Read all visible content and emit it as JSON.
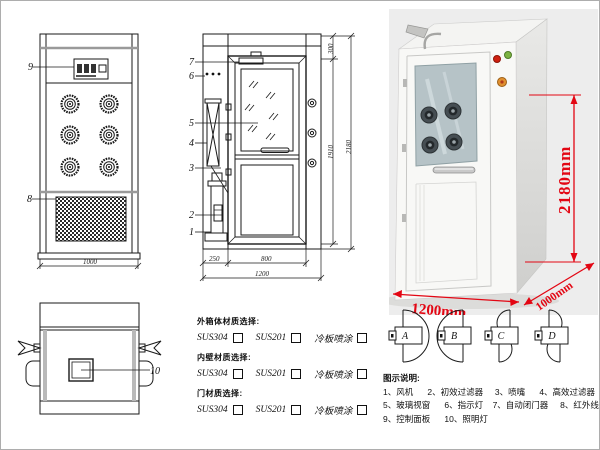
{
  "drawing": {
    "front_view": {
      "label_control_panel": "9",
      "label_grille": "8",
      "dim_width": "1000"
    },
    "side_view": {
      "labels": [
        "1",
        "2",
        "3",
        "4",
        "5",
        "6",
        "7"
      ],
      "dim_left": "250",
      "dim_door": "800",
      "dim_total": "1200",
      "dim_top": "300",
      "dim_mid": "1910",
      "dim_height": "2180"
    },
    "top_view": {
      "label_window": "10"
    }
  },
  "photo": {
    "dim_height": "2180mm",
    "dim_width": "1200mm",
    "dim_depth": "1000mm"
  },
  "materials": {
    "groups": [
      {
        "heading": "外箱体材质选择:",
        "options": [
          {
            "label": "SUS304"
          },
          {
            "label": "SUS201"
          },
          {
            "label": "冷板喷涂"
          }
        ]
      },
      {
        "heading": "内壁材质选择:",
        "options": [
          {
            "label": "SUS304"
          },
          {
            "label": "SUS201"
          },
          {
            "label": "冷板喷涂"
          }
        ]
      },
      {
        "heading": "门材质选择:",
        "options": [
          {
            "label": "SUS304"
          },
          {
            "label": "SUS201"
          },
          {
            "label": "冷板喷涂"
          }
        ]
      }
    ]
  },
  "door_swing": {
    "labels": [
      "A",
      "B",
      "C",
      "D"
    ]
  },
  "legend": {
    "title": "图示说明:",
    "lines": [
      "1、风机      2、初效过滤器     3、喷嘴      4、高效过滤器",
      "5、玻璃视窗      6、指示灯    7、自动闭门器     8、红外线感应器",
      "9、控制面板      10、照明灯"
    ]
  }
}
